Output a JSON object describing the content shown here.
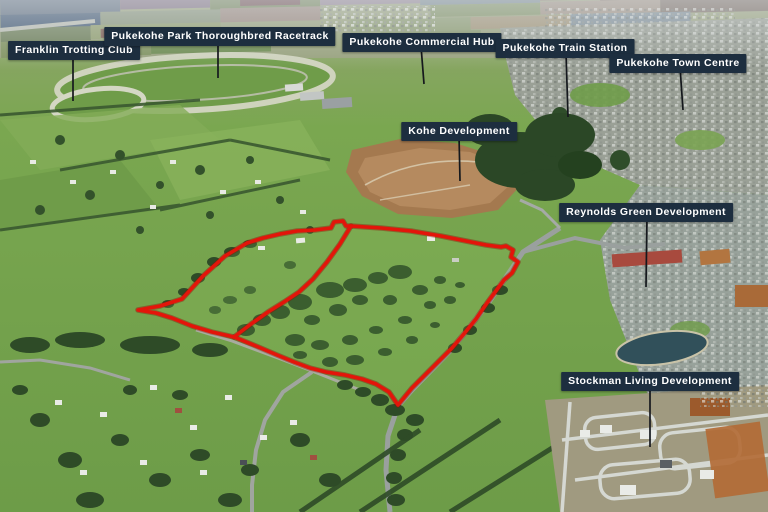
{
  "title": "Aerial marketing photograph of land for sale, Pukekohe",
  "colors": {
    "label_bg": "#1d2e3f",
    "label_text": "#ffffff",
    "leader": "#15181d",
    "boundary_red": "#e3150a",
    "boundary_shadow": "#8f0e05",
    "property_tint": "#93c763"
  },
  "labels": [
    {
      "id": "franklin-trotting-club",
      "text": "Franklin Trotting Club",
      "cx": 74,
      "top": 41,
      "leader": {
        "x1": 73,
        "y1": 54,
        "x2": 73,
        "y2": 101
      }
    },
    {
      "id": "pukekohe-park-thoroughbred-racetrack",
      "text": "Pukekohe Park Thoroughbred Racetrack",
      "cx": 220,
      "top": 27,
      "leader": {
        "x1": 218,
        "y1": 40,
        "x2": 218,
        "y2": 78
      }
    },
    {
      "id": "pukekohe-commercial-hub",
      "text": "Pukekohe Commercial Hub",
      "cx": 422,
      "top": 33,
      "leader": {
        "x1": 421,
        "y1": 46,
        "x2": 424,
        "y2": 84
      }
    },
    {
      "id": "pukekohe-train-station",
      "text": "Pukekohe Train Station",
      "cx": 565,
      "top": 39,
      "leader": {
        "x1": 566,
        "y1": 52,
        "x2": 568,
        "y2": 117
      }
    },
    {
      "id": "pukekohe-town-centre",
      "text": "Pukekohe Town Centre",
      "cx": 678,
      "top": 54,
      "leader": {
        "x1": 680,
        "y1": 67,
        "x2": 683,
        "y2": 110
      }
    },
    {
      "id": "kohe-development",
      "text": "Kohe Development",
      "cx": 459,
      "top": 122,
      "leader": {
        "x1": 459,
        "y1": 135,
        "x2": 460,
        "y2": 181
      }
    },
    {
      "id": "reynolds-green-development",
      "text": "Reynolds Green Development",
      "cx": 646,
      "top": 203,
      "leader": {
        "x1": 647,
        "y1": 216,
        "x2": 646,
        "y2": 287
      }
    },
    {
      "id": "stockman-living-development",
      "text": "Stockman Living Development",
      "cx": 650,
      "top": 372,
      "leader": {
        "x1": 650,
        "y1": 385,
        "x2": 650,
        "y2": 447
      }
    }
  ],
  "boundary": {
    "outer_path": "M 138,310 L 160,306 L 182,299 L 203,276 L 225,256 L 247,243 L 263,238 L 280,234 L 297,231 L 315,230 L 331,228 L 334,222 L 343,221 L 346,226 L 351,226 L 381,228 L 411,231 L 441,236 L 466,241 L 486,245 L 501,247 L 506,246 L 513,250 L 511,257 L 518,262 L 512,273 L 504,280 L 487,303 L 476,319 L 463,335 L 452,348 L 440,360 L 425,375 L 412,388 L 398,405 L 389,392 L 376,384 L 362,379 L 345,375 L 326,372 L 310,368 L 294,362 L 277,355 L 256,346 L 234,337 L 212,332 L 192,326 L 172,318 L 156,313 Z",
    "divider_path": "M 351,226 L 340,244 L 327,262 L 313,279 L 299,292 L 284,302 L 268,312 L 251,324 L 234,337",
    "stroke_width": 3.6
  }
}
